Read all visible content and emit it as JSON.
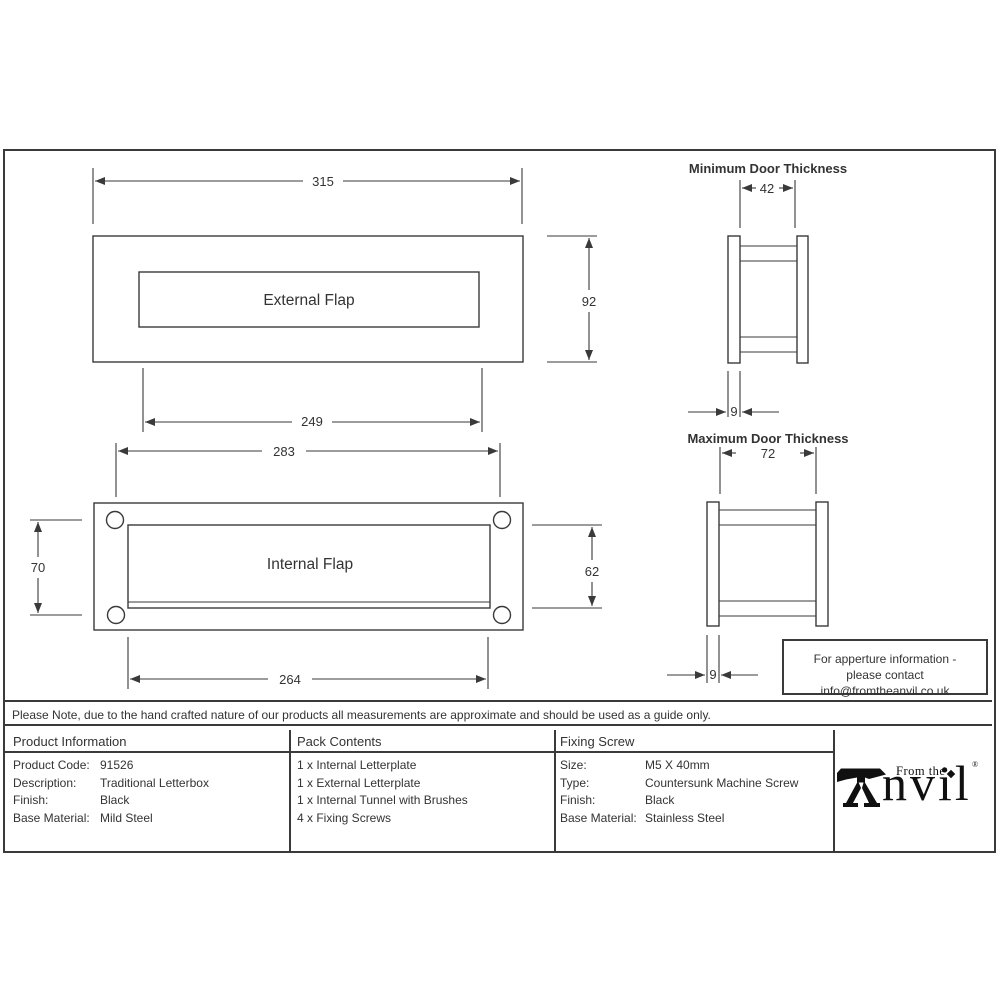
{
  "colors": {
    "ink": "#333333",
    "line": "#3a3a3a",
    "logo_black": "#101010"
  },
  "drawings": {
    "external_flap": {
      "label": "External Flap",
      "width_dim": "315",
      "height_dim": "92",
      "flap_width_dim": "249"
    },
    "internal_flap": {
      "label": "Internal Flap",
      "width_dim": "283",
      "holes_height_dim": "70",
      "flap_height_dim": "62",
      "flap_width_dim": "264"
    },
    "min_door": {
      "title": "Minimum Door Thickness",
      "thickness_dim": "42",
      "plate_dim": "9"
    },
    "max_door": {
      "title": "Maximum Door Thickness",
      "thickness_dim": "72",
      "plate_dim": "9"
    }
  },
  "aperture_box": {
    "line1": "For apperture information -",
    "line2": "please contact info@fromtheanvil.co.uk"
  },
  "disclaimer": "Please Note, due to the hand crafted nature of our products all measurements are approximate and should be used as a guide only.",
  "table": {
    "product_information": {
      "header": "Product Information",
      "rows": [
        {
          "label": "Product Code:",
          "value": "91526"
        },
        {
          "label": "Description:",
          "value": "Traditional Letterbox"
        },
        {
          "label": "Finish:",
          "value": "Black"
        },
        {
          "label": "Base Material:",
          "value": "Mild Steel"
        }
      ]
    },
    "pack_contents": {
      "header": "Pack Contents",
      "items": [
        "1 x Internal Letterplate",
        "1 x External Letterplate",
        "1 x Internal Tunnel with Brushes",
        "4 x Fixing Screws"
      ]
    },
    "fixing_screw": {
      "header": "Fixing Screw",
      "rows": [
        {
          "label": "Size:",
          "value": "M5 X 40mm"
        },
        {
          "label": "Type:",
          "value": "Countersunk Machine Screw"
        },
        {
          "label": "Finish:",
          "value": "Black"
        },
        {
          "label": "Base Material:",
          "value": "Stainless Steel"
        }
      ]
    }
  },
  "logo": {
    "prefix": "From the",
    "word": "nvil",
    "registered": "®"
  }
}
